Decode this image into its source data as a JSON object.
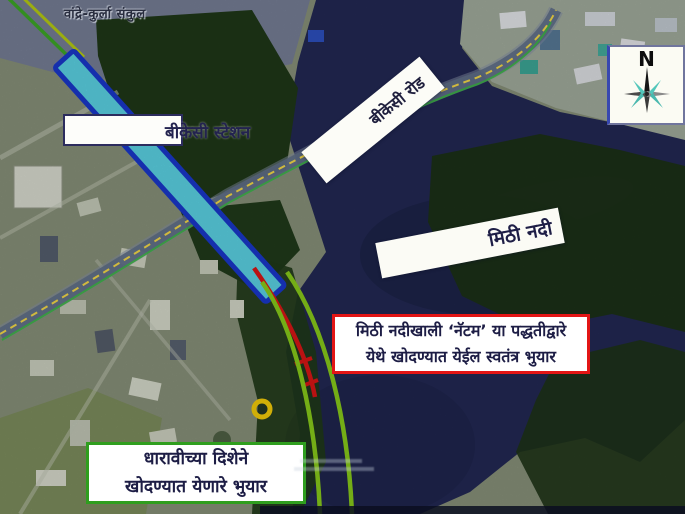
{
  "map": {
    "area_label_top": "वांद्रे-कुर्ला संकुल",
    "station_label": "बीकेसी स्टेशन",
    "road_label": "बीकेसी रोड",
    "river_label": "मिठी नदी",
    "tunnel_callout": {
      "line1": "मिठी नदीखाली ‘नॅटम’ या पद्धतीद्वारे",
      "line2": "येथे खोदण्यात येईल स्वतंत्र भुयार"
    },
    "dharavi_callout": {
      "line1": "धारावीच्या दिशेने",
      "line2": "खोदण्यात येणारे भुयार"
    },
    "compass": {
      "north_label": "N"
    },
    "colors": {
      "station_fill": "#5fdcee",
      "station_border": "#1a3ad4",
      "metro_line_green": "#8fd41c",
      "tunnel_line_red": "#e31717",
      "marker_ring_yellow": "#ffd60a",
      "water": "#242a57",
      "mangrove": "#1d3416",
      "tunnel_note_border": "#e31515",
      "dharavi_note_border": "#2f9e1e"
    }
  }
}
